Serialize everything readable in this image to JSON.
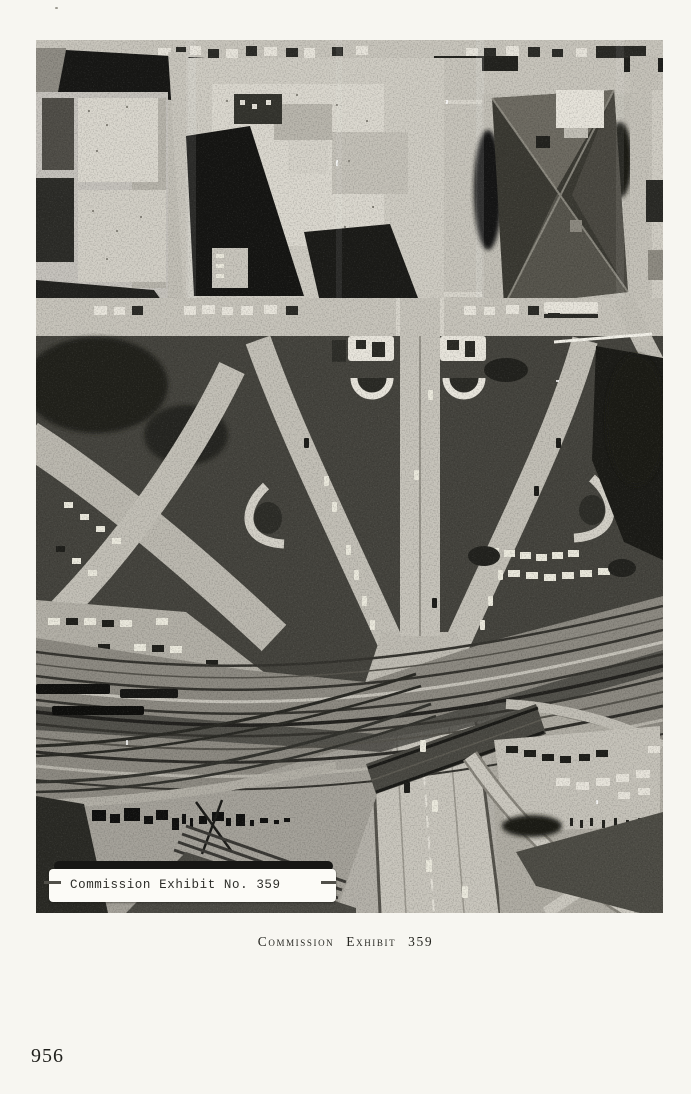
{
  "page": {
    "caption": "Commission Exhibit 359",
    "page_number": "956"
  },
  "photo": {
    "label": "Commission Exhibit No. 359",
    "alt": "Black-and-white aerial photograph of Dealey Plaza, Dallas: downtown blocks and a dark hip-roofed courthouse at top, a Y-shaped road junction with twin white peristyle structures and dark grass panels in the center, curved streets with parked cars at the sides, and a diagonal railroad corridor crossing the triple underpass and freeway at the bottom",
    "tones": {
      "paper": "#f7f6f1",
      "concrete": "#c6c3ba",
      "grass": "#45443e",
      "shadow": "#161614",
      "label_bar": "#171715",
      "label_strip": "#fcfbf7"
    }
  }
}
